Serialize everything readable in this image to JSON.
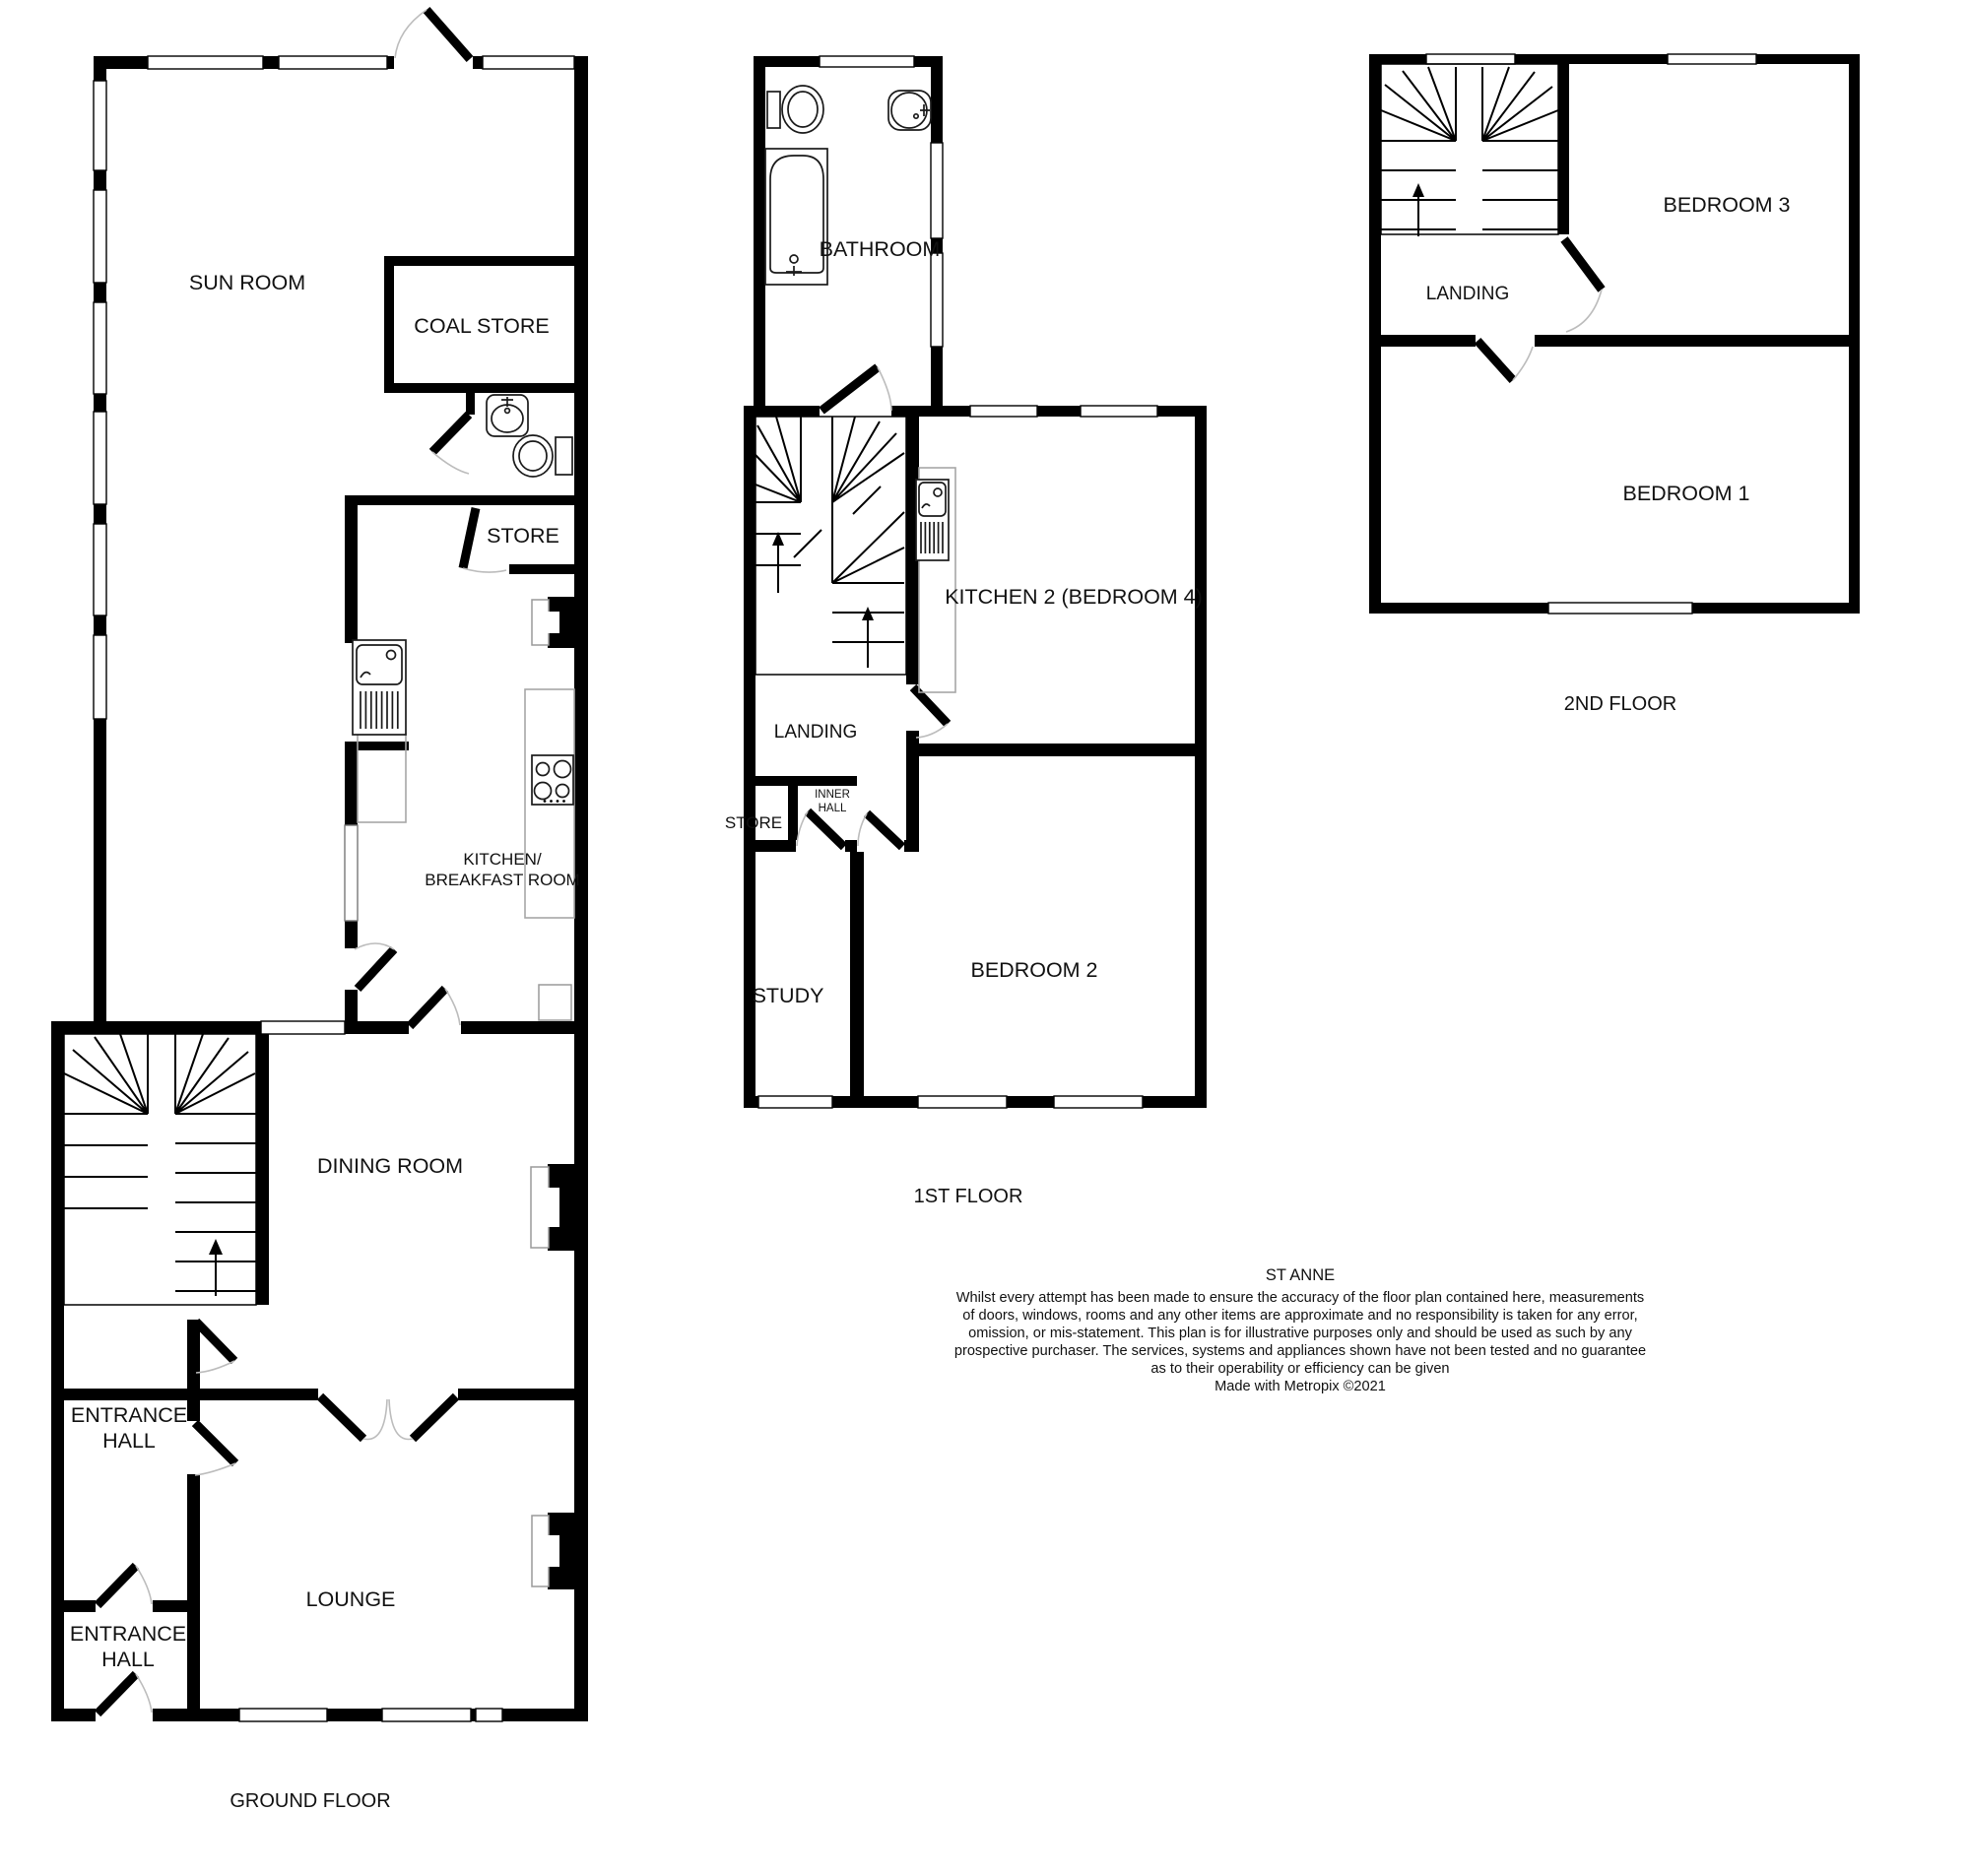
{
  "plan": {
    "property_name": "ST ANNE",
    "credit": "Made with Metropix ©2021",
    "disclaimer": {
      "line1": "Whilst every attempt has been made to ensure the accuracy of the floor plan contained here, measurements",
      "line2": "of doors, windows, rooms and any other items are approximate and no responsibility is taken for any error,",
      "line3": "omission, or mis-statement. This plan is for illustrative purposes only and should be used as such by any",
      "line4": "prospective purchaser. The services, systems and appliances shown have not been tested and no guarantee",
      "line5": "as to their operability or efficiency can be given"
    },
    "floors": {
      "ground": {
        "title": "GROUND FLOOR",
        "rooms": {
          "sun_room": "SUN ROOM",
          "coal_store": "COAL STORE",
          "store": "STORE",
          "kitchen_breakfast_line1": "KITCHEN/",
          "kitchen_breakfast_line2": "BREAKFAST ROOM",
          "dining_room": "DINING ROOM",
          "entrance_hall_1_line1": "ENTRANCE",
          "entrance_hall_1_line2": "HALL",
          "lounge": "LOUNGE",
          "entrance_hall_2_line1": "ENTRANCE",
          "entrance_hall_2_line2": "HALL"
        }
      },
      "first": {
        "title": "1ST FLOOR",
        "rooms": {
          "bathroom": "BATHROOM",
          "kitchen2": "KITCHEN 2 (BEDROOM 4)",
          "landing": "LANDING",
          "inner_hall_line1": "INNER",
          "inner_hall_line2": "HALL",
          "store": "STORE",
          "study": "STUDY",
          "bedroom2": "BEDROOM 2"
        }
      },
      "second": {
        "title": "2ND FLOOR",
        "rooms": {
          "bedroom3": "BEDROOM 3",
          "landing": "LANDING",
          "bedroom1": "BEDROOM 1"
        }
      }
    }
  }
}
